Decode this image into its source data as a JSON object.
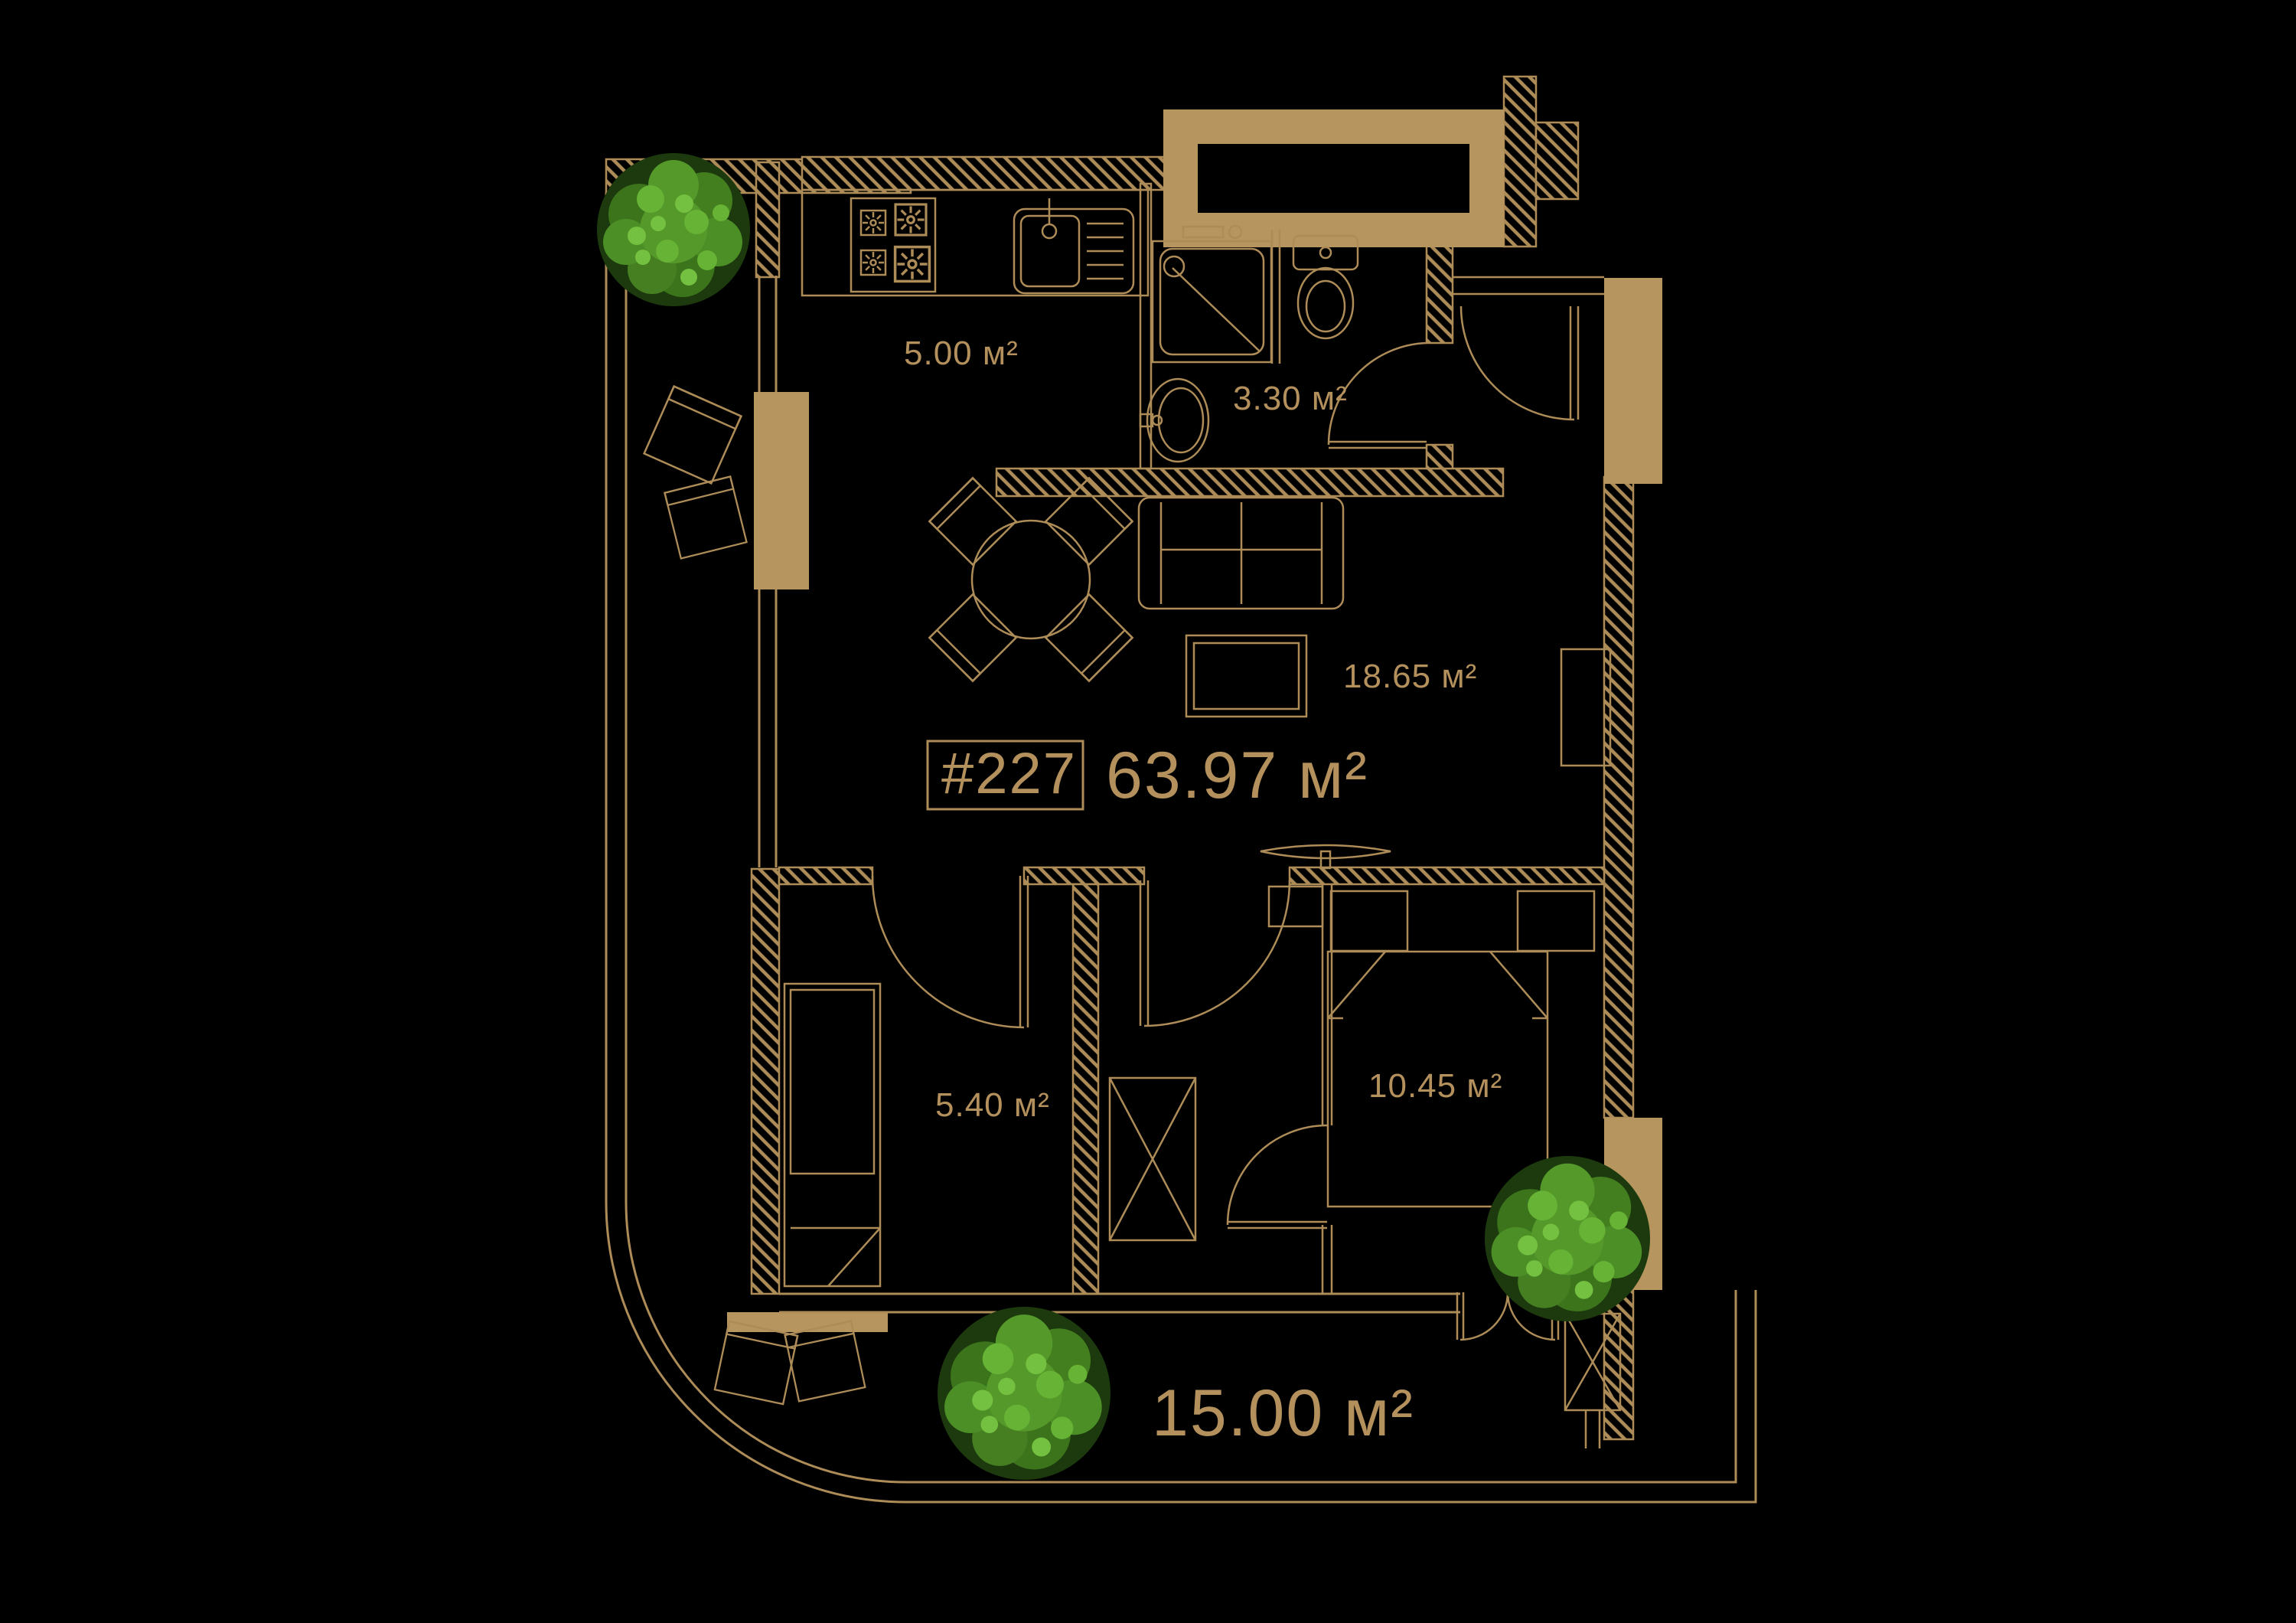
{
  "floor_plan": {
    "apartment": {
      "number": "#227",
      "total_area": "63.97 м²"
    },
    "rooms": [
      {
        "id": "kitchen",
        "area": "5.00 м²"
      },
      {
        "id": "bathroom",
        "area": "3.30 м²"
      },
      {
        "id": "living-room",
        "area": "18.65 м²"
      },
      {
        "id": "bedroom-small",
        "area": "5.40 м²"
      },
      {
        "id": "bedroom",
        "area": "10.45 м²"
      },
      {
        "id": "terrace",
        "area": "15.00 м²"
      }
    ],
    "colors": {
      "background": "#000000",
      "line_gold": "#ad8c58",
      "fill_gold": "#b7955e",
      "text_gold": "#b3905c",
      "tree_dark": "#2f5a17",
      "tree_mid": "#4d8f27",
      "tree_light": "#67b335"
    }
  }
}
